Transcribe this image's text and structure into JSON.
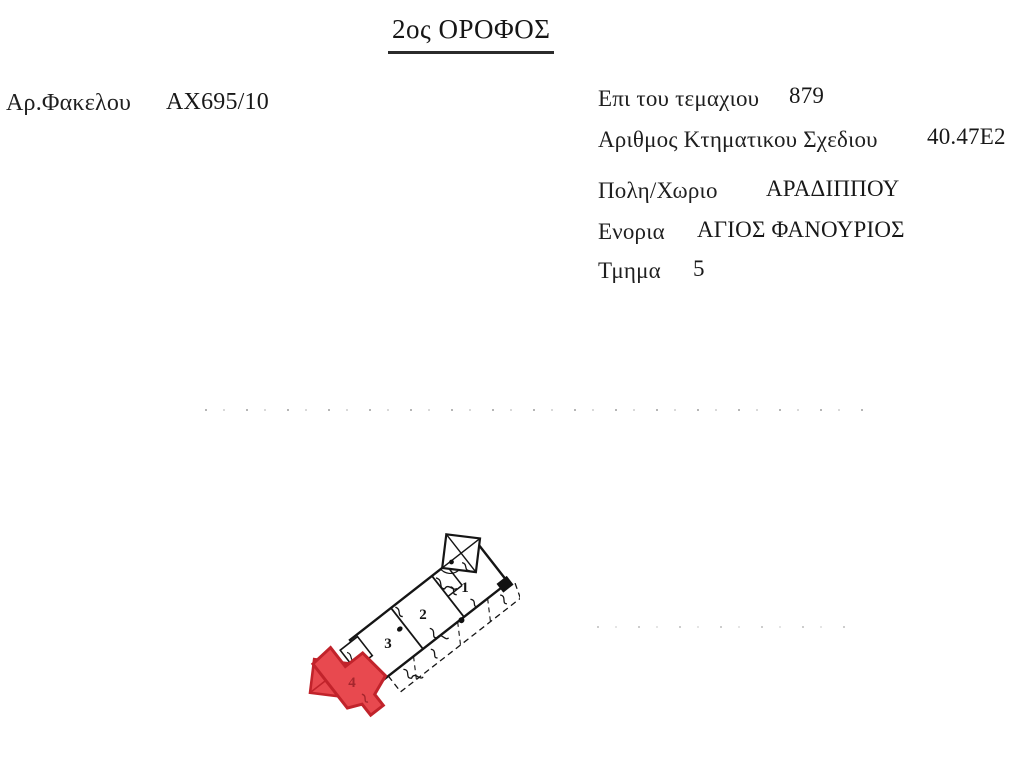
{
  "document": {
    "title": "2ος ΟΡΟΦΟΣ",
    "fields": [
      {
        "label": "Αρ.Φακελου",
        "value": "AX695/10"
      },
      {
        "label": "Επι του τεμαχιου",
        "value": "879"
      },
      {
        "label": "Αριθμος Κτηματικου Σχεδιου",
        "value": "40.47E2"
      },
      {
        "label": "Πολη/Χωριο",
        "value": "ΑΡΑΔΙΠΠΟΥ"
      },
      {
        "label": "Ενορια",
        "value": "ΑΓΙΟΣ ΦΑΝΟΥΡΙΟΣ"
      },
      {
        "label": "Τμημα",
        "value": "5"
      }
    ],
    "floor_plan": {
      "unit_labels": [
        "1",
        "2",
        "3",
        "4"
      ],
      "highlighted_unit": "4",
      "colors": {
        "highlight_fill": "#e8494f",
        "highlight_stroke": "#c1232b",
        "highlight_label": "#a5262d",
        "line": "#151515"
      }
    }
  }
}
